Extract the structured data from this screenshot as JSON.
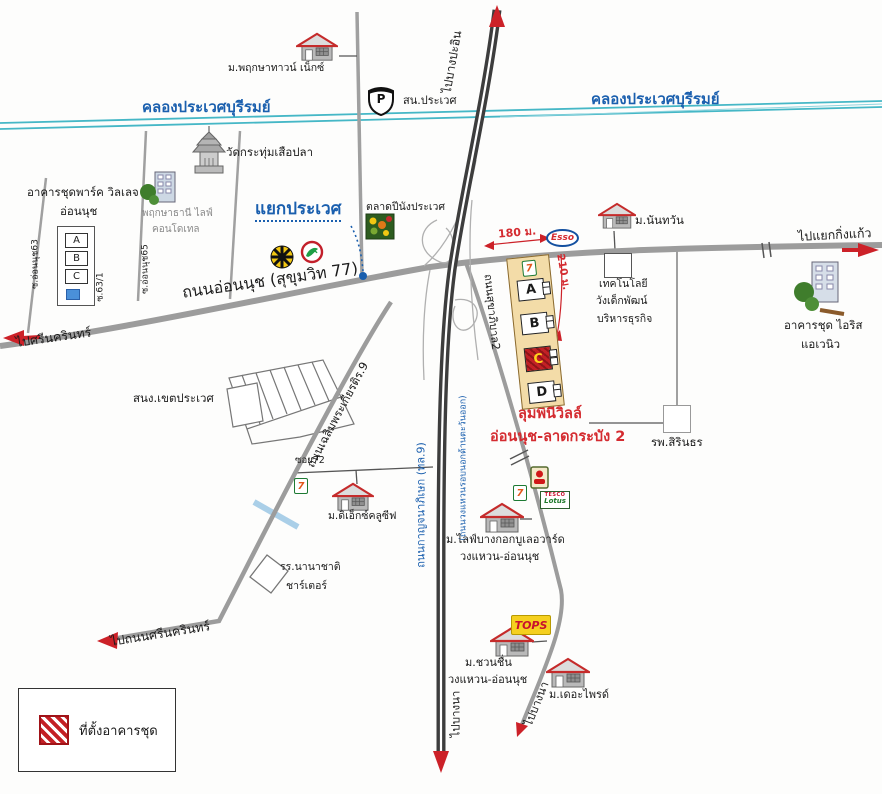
{
  "canal": {
    "name": "คลองประเวศบุรีรมย์"
  },
  "junction": {
    "prawet": "แยกประเวศ"
  },
  "roads": {
    "onnut": "ถนนอ่อนนุช (สุขุมวิท 77)",
    "sukhaphiban2": "ถนนสุขาภิบาล2",
    "chalermprakiat": "ถนนเฉลิมพระเกียรติร.9",
    "kanchanaphisek": "ถนนกาญจนาภิเษก (ทล.9)",
    "outer_ring": "(ถนนวงแหวนรอบนอกด้านตะวันออก)",
    "soi_onnut63": "ซ.อ่อนนุช63",
    "soi_63_1": "ซ.63/1",
    "soi_onnut65": "ซ.อ่อนนุช65",
    "soi72": "ซอย72"
  },
  "directions": {
    "to_bang_pa_in": "ไปบางปะอิน",
    "to_king_kaew": "ไปแยกกิ่งแก้ว",
    "to_srinakarin": "ไปศรีนครินทร์",
    "to_srinakarin_road": "ไปถนนศรีนครินทร์",
    "to_bang_na": "ไปบางนา"
  },
  "distances": {
    "esso_180m": "180 ม.",
    "condo_210m": "210 ม."
  },
  "project": {
    "name": "ลุมพินีวิลล์",
    "name2": "อ่อนนุช-ลาดกระบัง 2",
    "blocks": [
      "A",
      "B",
      "C",
      "D"
    ]
  },
  "places": {
    "pruksa_town": "ม.พฤกษาทาวน์ เน็กซ์",
    "police": {
      "label": "สน.ประเวศ",
      "badge": "P"
    },
    "temple": "วัดกระทุ่มเสือปลา",
    "park_village": {
      "line1": "อาคารชุดพาร์ค วิลเลจ",
      "line2": "อ่อนนุช",
      "blocks": [
        "A",
        "B",
        "C"
      ]
    },
    "pruksathani": {
      "line1": "พฤกษาธานี ไลฟ์",
      "line2": "คอนโดเทล"
    },
    "market": "ตลาดปีนังประเวศ",
    "nantawan": "ม.นันทวัน",
    "technology": {
      "line1": "เทคโนโลยี",
      "line2": "วังเด็กพัฒน์",
      "line3": "บริหารธุรกิจ"
    },
    "iris": {
      "line1": "อาคารชุด ไอริส",
      "line2": "แอเวนิว"
    },
    "hospital": "รพ.สิรินธร",
    "district_office": "สนง.เขตประเวศ",
    "exclusive": "ม.ดิเอ็กซ์คลูซีฟ",
    "charter": {
      "line1": "รร.นานาชาติ",
      "line2": "ชาร์เตอร์"
    },
    "life_bangkok": {
      "line1": "ม.ไลฟ์บางกอกบูเลอวาร์ด",
      "line2": "วงแหวน-อ่อนนุช"
    },
    "chuan_chuen": {
      "line1": "ม.ชวนชื่น",
      "line2": "วงแหวน-อ่อนนุช"
    },
    "the_pride": "ม.เดอะไพรด์"
  },
  "brands": {
    "esso": "Esso",
    "tops": "TOPS",
    "seven_eleven": "7",
    "tesco": "TESCO",
    "lotus": "Lotus"
  },
  "legend": {
    "condo_location": "ที่ตั้งอาคารชุด"
  },
  "colors": {
    "canal": "#45b7c6",
    "road": "#9c9c9c",
    "motorway": "#3d3d3d",
    "red": "#cc2128",
    "blue_text": "#1a5fae",
    "condo_fill": "#f3dca8"
  }
}
